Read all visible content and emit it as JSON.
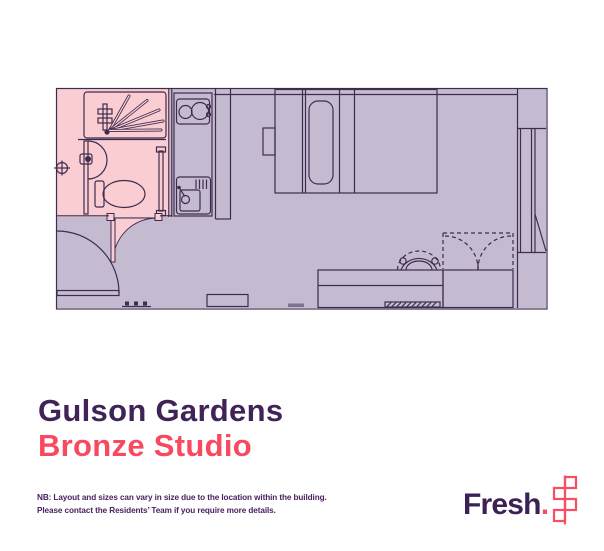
{
  "title": {
    "property_name": "Gulson Gardens",
    "unit_type": "Bronze Studio"
  },
  "note": {
    "line1": "NB: Layout and sizes can vary in size due to the location within the building.",
    "line2": "Please contact the Residents’ Team if you require more details."
  },
  "brand": {
    "wordmark": "Fresh",
    "period": ".",
    "icon": "fresh-squares-icon"
  },
  "colors": {
    "room-fill": "#c5bbd1",
    "bath-fill": "#facdd3",
    "plan-line": "#3e2c4d",
    "title-color": "#412457",
    "accent-color": "#f8495e",
    "note-color": "#4b2160",
    "logo-color": "#3b2154",
    "icon-color": "#fb4d61"
  },
  "floor_plan": {
    "unit": "studio apartment",
    "fixtures": [
      "bathroom",
      "shower",
      "wash-basin",
      "toilet",
      "kitchen-hob",
      "kitchen-sink",
      "double-bed",
      "pillow",
      "bedside-shelf",
      "entry-door",
      "bathroom-door",
      "wardrobe",
      "desk",
      "desk-chair",
      "window",
      "radiator",
      "coat-hooks"
    ]
  }
}
